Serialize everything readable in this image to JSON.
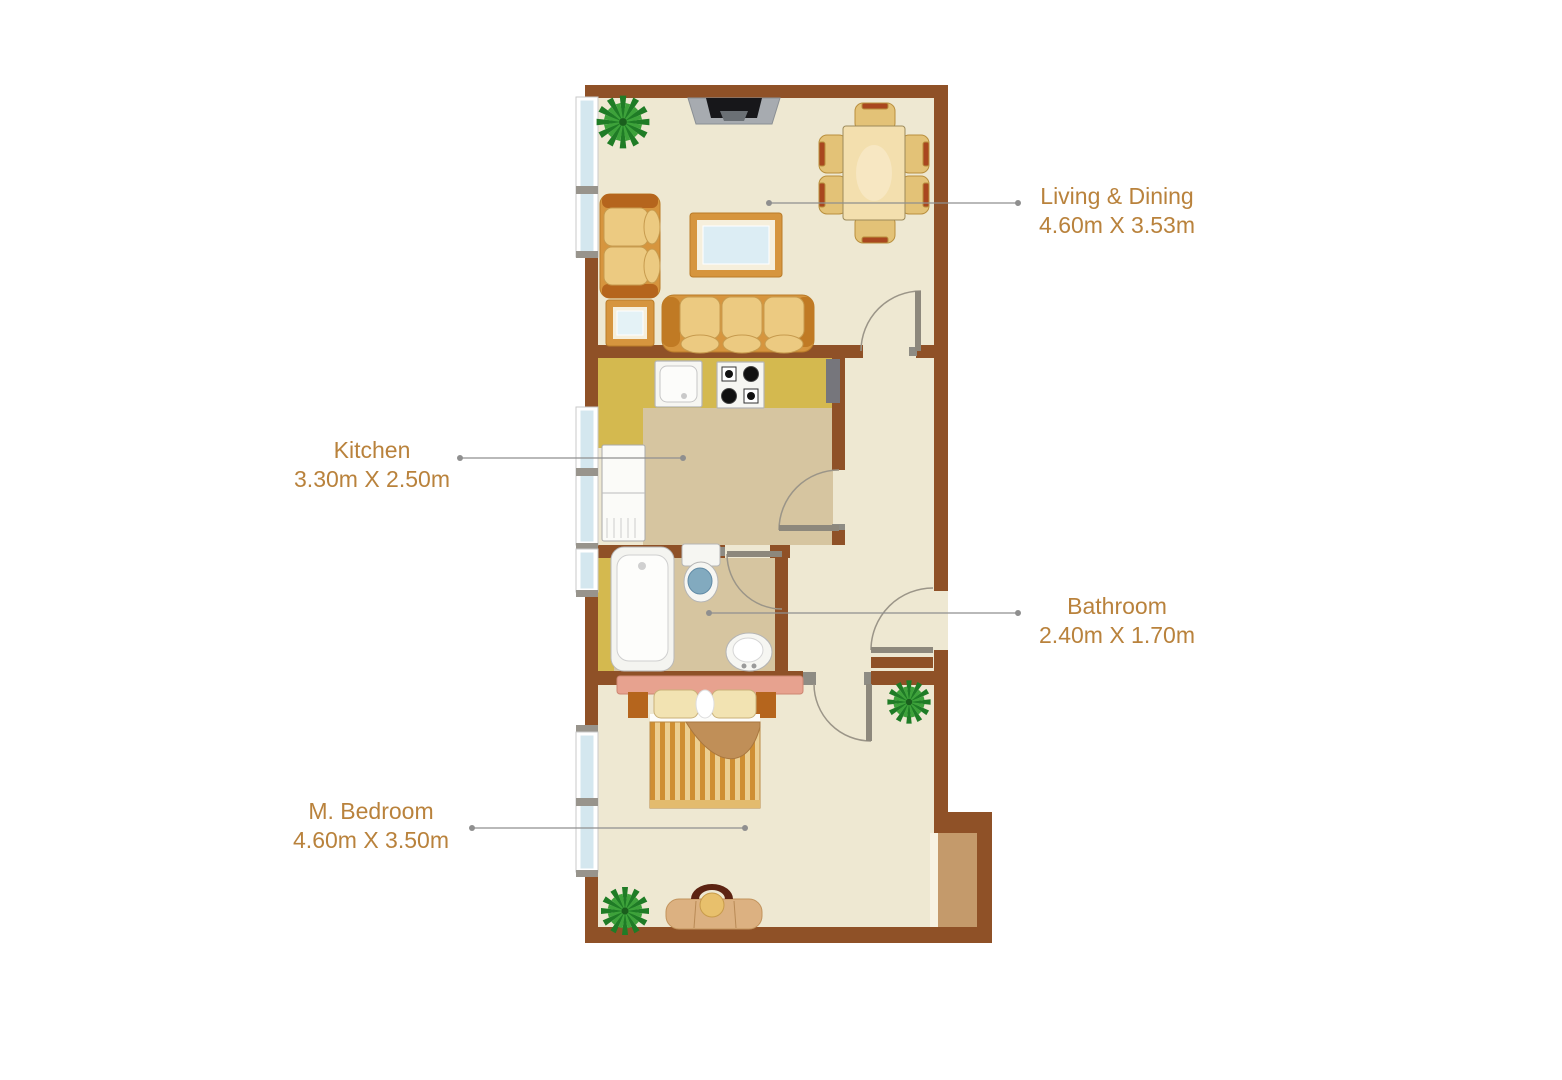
{
  "page": {
    "background_color": "#ffffff"
  },
  "colors": {
    "wall": "#8f5127",
    "floor": "#eee8d2",
    "kitchen_floor": "#d6c5a0",
    "counter": "#d4b94f",
    "balcony_floor": "#c49a6b",
    "window_glass": "#d4e7ef",
    "label_text": "#b9823c",
    "leader_line": "#8f8f8f",
    "plant_dark": "#1f7c26",
    "plant_light": "#3da23a"
  },
  "floor_plan": {
    "rooms": [
      {
        "name": "Living & Dining",
        "dimensions": "4.60m X 3.53m"
      },
      {
        "name": "Kitchen",
        "dimensions": "3.30m X 2.50m"
      },
      {
        "name": "Bathroom",
        "dimensions": "2.40m X 1.70m"
      },
      {
        "name": "M. Bedroom",
        "dimensions": "4.60m X 3.50m"
      }
    ],
    "furniture": [
      "tv",
      "dining-table",
      "dining-chairs",
      "loveseat",
      "coffee-table",
      "side-table",
      "sofa",
      "plant",
      "kitchen-sink",
      "stove",
      "refrigerator",
      "bathtub",
      "toilet",
      "wash-basin",
      "double-bed",
      "vanity-chair",
      "balcony",
      "windows",
      "doors"
    ]
  }
}
